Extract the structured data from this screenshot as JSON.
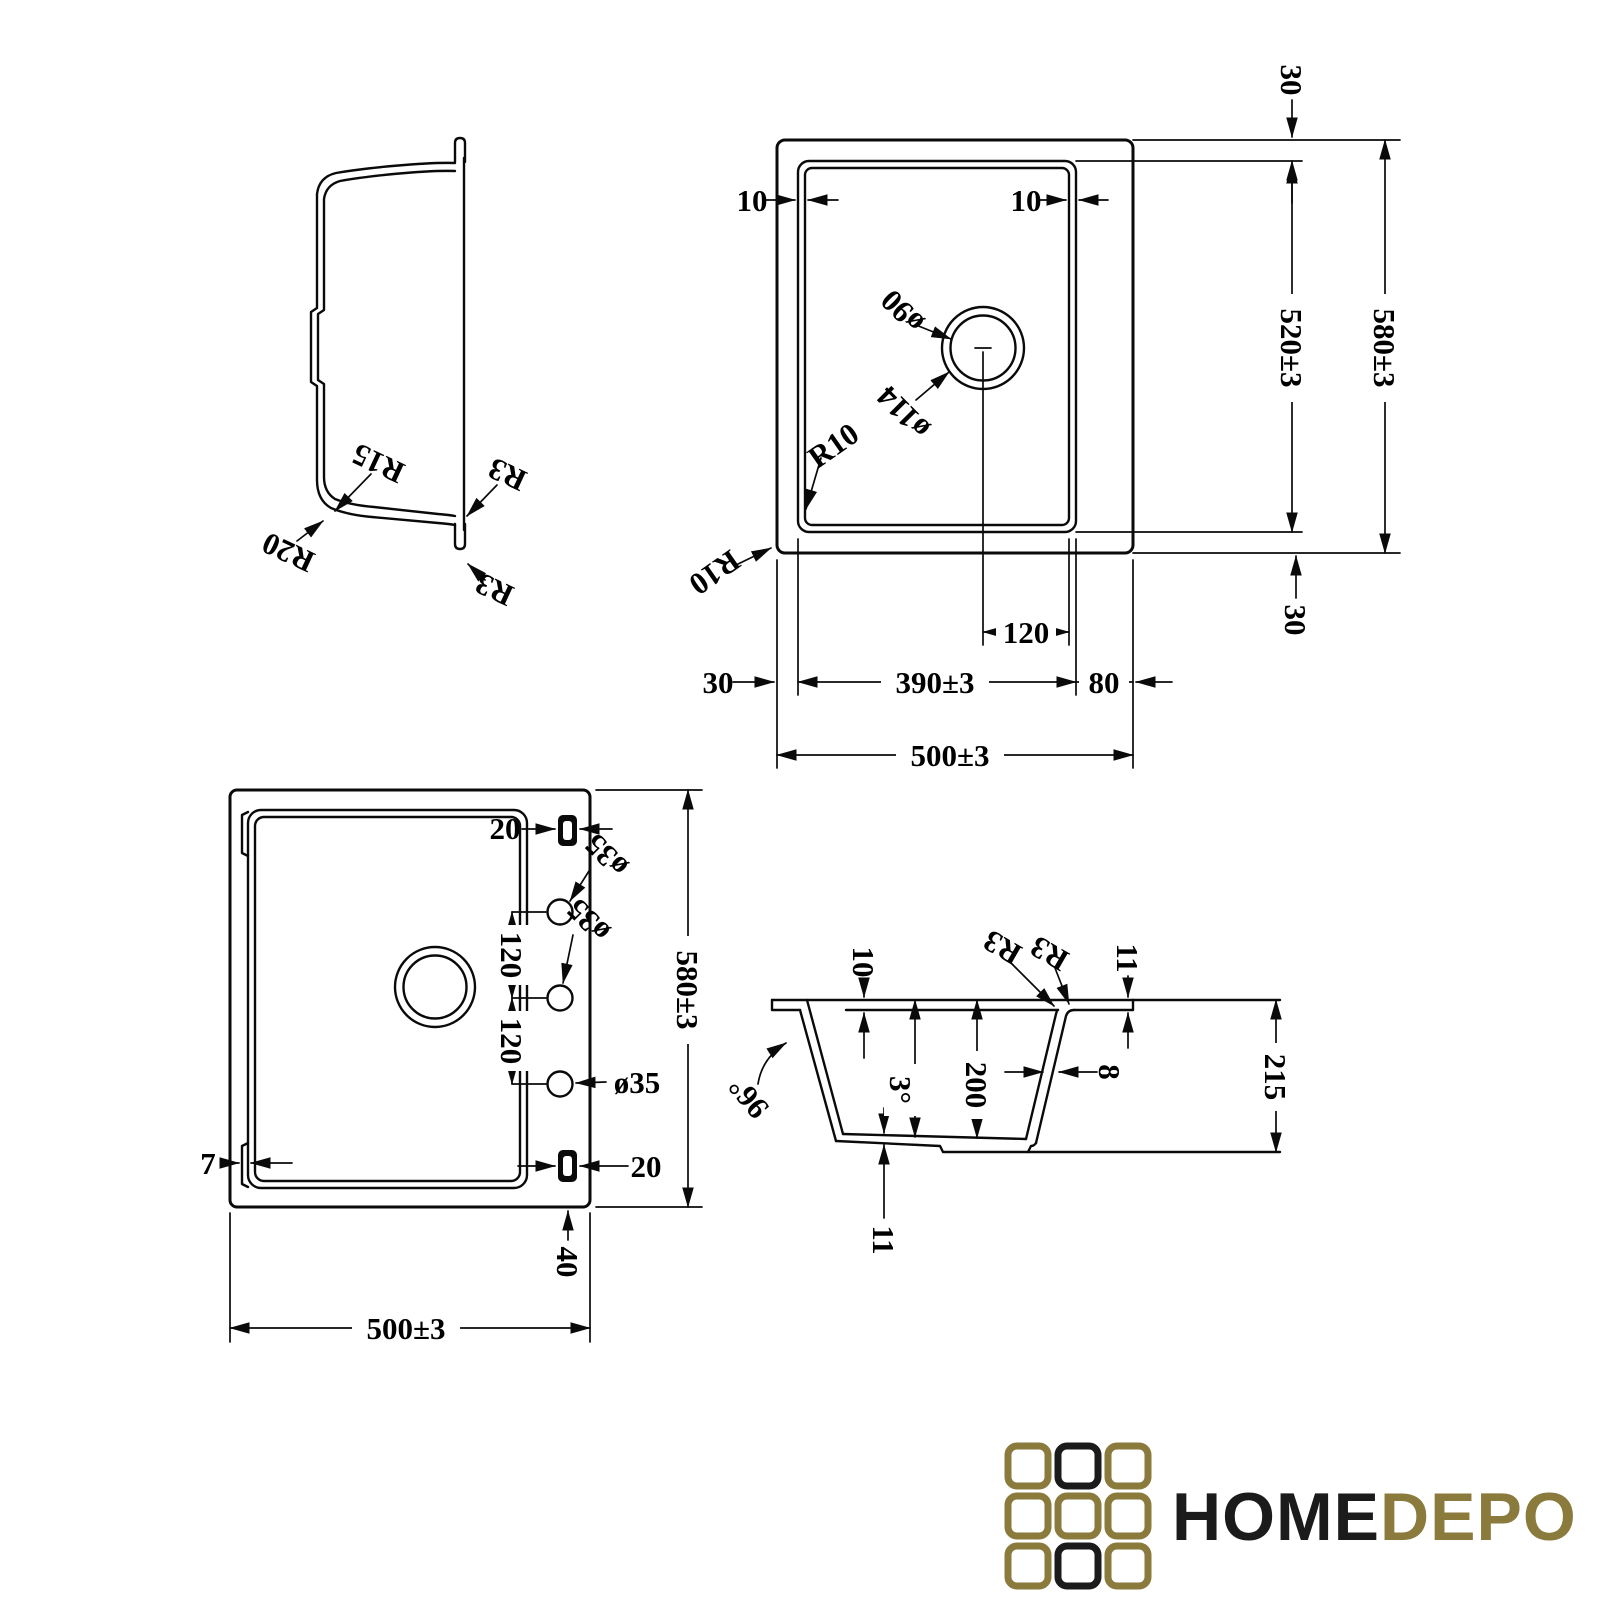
{
  "drawing": {
    "side_view": {
      "r15": "R15",
      "r20": "R20",
      "r3_inner": "R3",
      "r3_outer": "R3"
    },
    "top_view": {
      "rim_left": "10",
      "rim_right": "10",
      "edge_top": "30",
      "bowl_length": "520±3",
      "overall_length": "580±3",
      "edge_bottom": "30",
      "edge_left": "30",
      "bowl_width": "390±3",
      "deck_right": "80",
      "overall_width": "500±3",
      "drain_offset": "120",
      "drain_hole": "ø90",
      "drain_flange": "ø114",
      "corner_bowl": "R10",
      "corner_outer": "R10"
    },
    "bottom_view": {
      "clip_top": "20",
      "clip_bottom": "20",
      "tap_hole_1": "ø35",
      "tap_hole_2": "ø35",
      "tap_hole_3": "ø35",
      "spacing_1": "120",
      "spacing_2": "120",
      "rim_lip": "7",
      "ledge": "40",
      "overall_width": "500±3",
      "overall_length": "580±3"
    },
    "section_view": {
      "rim_depth": "10",
      "radius_inner": "R3",
      "radius_outer": "R3",
      "lip_height": "11",
      "wall_angle": "96°",
      "draft_angle": "3°",
      "bowl_depth": "200",
      "wall_thickness": "8",
      "overall_depth": "215",
      "bottom_thickness": "11"
    }
  },
  "logo": {
    "word_primary": "HOME",
    "word_secondary": "DEPO",
    "color_primary": "#1b1b1b",
    "color_secondary": "#8a7a3c",
    "cells": [
      "#8a7a3c",
      "#1b1b1b",
      "#8a7a3c",
      "#8a7a3c",
      "#8a7a3c",
      "#8a7a3c",
      "#8a7a3c",
      "#1b1b1b",
      "#8a7a3c"
    ]
  }
}
